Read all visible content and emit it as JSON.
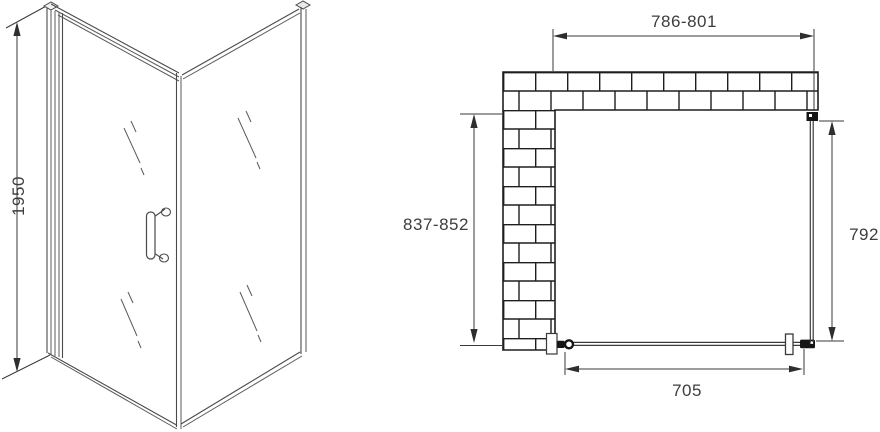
{
  "diagram": {
    "title": "shower-enclosure-technical-drawing",
    "views": {
      "perspective": {
        "name": "perspective view of hinged door with side panel"
      },
      "plan": {
        "name": "top plan view with wall section"
      }
    }
  },
  "dimensions": {
    "height": "1950",
    "width_range": "786-801",
    "depth_range": "837-852",
    "side_panel_depth": "792",
    "door_width": "705"
  },
  "colors": {
    "background": "#ffffff",
    "line": "#4a4a4a",
    "dimension_line": "#3a3a3a",
    "text": "#3d3d3d",
    "wall_outline": "#1f1f1f"
  }
}
